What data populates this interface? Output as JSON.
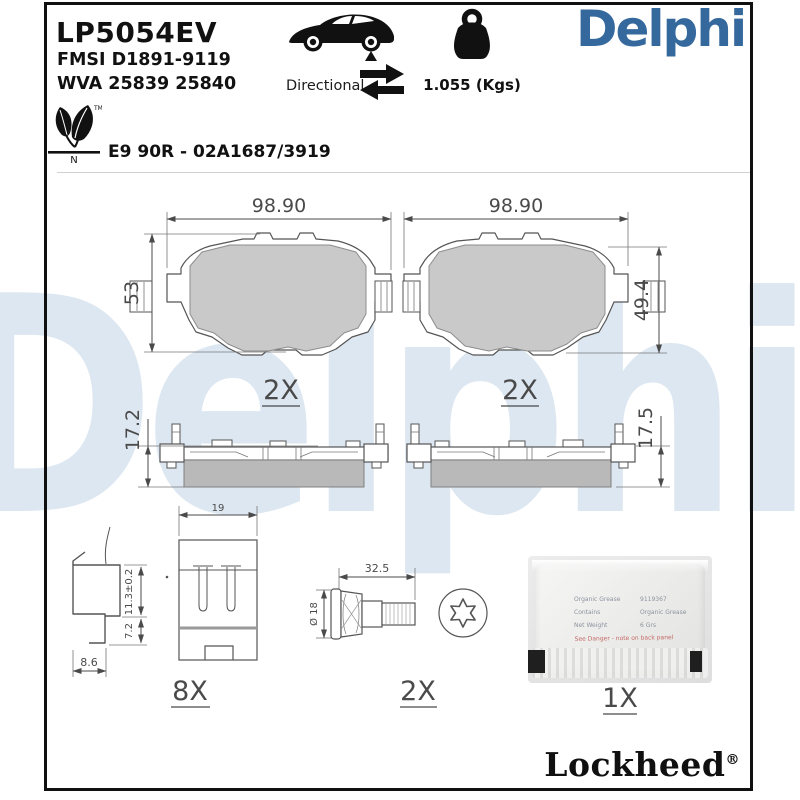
{
  "watermark": {
    "text": "Delphi"
  },
  "header": {
    "part_number": "LP5054EV",
    "fmsi_line": "FMSI D1891-9119",
    "wva_line": "WVA 25839 25840",
    "directional_label": "Directional",
    "weight_label": "1.055 (Kgs)",
    "brand_logo": "Delphi",
    "eco_tm": "TM",
    "eco_n": "N",
    "approval_line": "E9 90R - 02A1687/3919"
  },
  "drawings": {
    "pad_left": {
      "width": "98.90",
      "height": "53",
      "qty": "2X"
    },
    "pad_right": {
      "width": "98.90",
      "height": "49.4",
      "qty": "2X"
    },
    "side_left": {
      "thickness": "17.2"
    },
    "side_right": {
      "thickness": "17.5"
    },
    "clip": {
      "height_upper": "11.3±0.2",
      "height_lower": "7.2",
      "width": "8.6"
    },
    "shim": {
      "width": "19",
      "qty": "8X"
    },
    "bolt": {
      "length": "32.5",
      "diameter": "Ø 18",
      "qty": "2X"
    },
    "sachet": {
      "row1_label": "Organic Grease",
      "row1_value": "9119367",
      "row2_label": "Contains",
      "row2_value": "Organic Grease",
      "row3_label": "Net Weight",
      "row3_value": "6 Grs",
      "warning": "See Danger - note on back panel",
      "qty": "1X"
    }
  },
  "footer": {
    "brand": "Lockheed",
    "registered": "®"
  },
  "colors": {
    "brand_blue": "#35699e",
    "watermark_blue": "#dde7f1",
    "line_gray": "#4a4a4a"
  }
}
